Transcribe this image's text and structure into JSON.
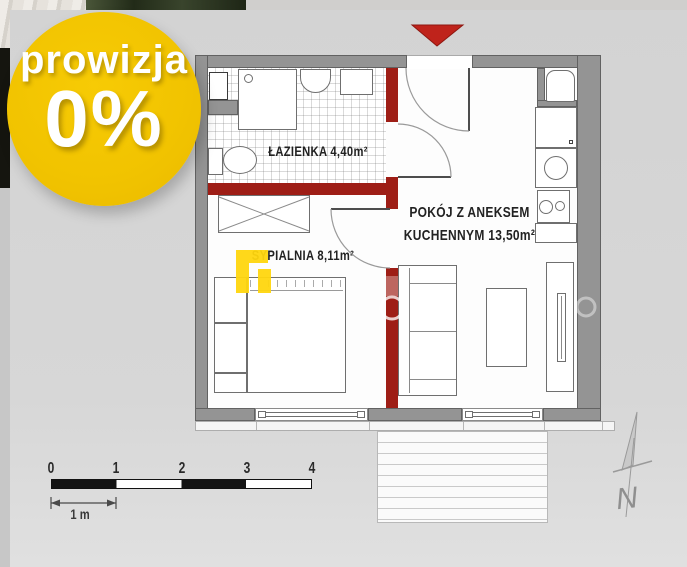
{
  "badge": {
    "line1": "prowizja",
    "line2": "0%"
  },
  "rooms": {
    "bathroom": {
      "label": "ŁAZIENKA 4,40m²"
    },
    "bedroom": {
      "label": "SYPIALNIA  8,11m²"
    },
    "living": {
      "line1": "POKÓJ Z ANEKSEM",
      "line2": "KUCHENNYM  13,50m²"
    }
  },
  "scale": {
    "ticks": [
      "0",
      "1",
      "2",
      "3",
      "4"
    ],
    "unit": "1 m"
  },
  "compass": {
    "north": "N"
  },
  "colors": {
    "badge_yellow": "#f2c500",
    "logo_yellow": "#ffd60e",
    "partition_red": "#9e1e16",
    "entrance_red": "#bf231b",
    "wall_gray": "#949494",
    "panel_gray": "#d6d6d6"
  }
}
